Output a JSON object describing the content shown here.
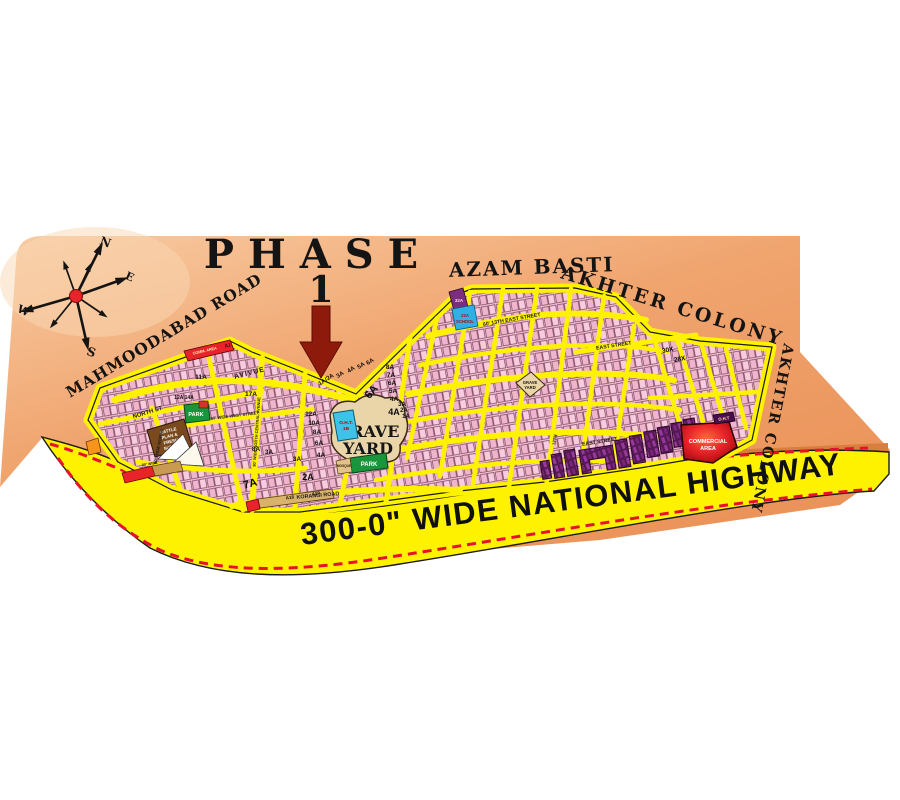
{
  "title": {
    "word": "PHASE",
    "number": "1"
  },
  "regions": {
    "azam_basti": "AZAM BASTI",
    "akhter_colony_top": "AKHTER COLONY",
    "akhter_colony_right": "AKHTER COLONY",
    "mahmoodabad_road": "MAHMOODABAD ROAD"
  },
  "highway_label": "300-0\" WIDE NATIONAL HIGHWAY",
  "compass": {
    "n": "N",
    "s": "S",
    "e": "E",
    "w": "W"
  },
  "landmarks": {
    "grave_yard_lines": [
      "GRAVE",
      "YARD"
    ],
    "grave_yard_small_lines": [
      "GRAVE",
      "YARD"
    ],
    "park_left": "PARK",
    "park_center": "PARK",
    "mosque": "MOSQUE",
    "commercial_lines": [
      "COMMERCIAL",
      "AREA"
    ],
    "comm_a1": "COMM. AREA",
    "comm_a1_code": "A1",
    "cattle_lines": [
      "CATTLE",
      "PLAN &",
      "FRESH",
      "SUPPLY"
    ],
    "oht_lines": [
      "O.H.T.",
      "1B"
    ],
    "oht_small": "O.H.T",
    "school22_lines": [
      "22A",
      "SCHOOL"
    ],
    "school32": "32A",
    "a18": "A18",
    "a19": "A19"
  },
  "streets": {
    "avenue": "AVIVUE",
    "north_st": "NORTH ST",
    "wide_north": "60' WIDE NORTH",
    "north_central": "90' WIDE NORTH CENTRAL AVENUE",
    "west_street": "60' WIDE WEST STREET",
    "korangi": "KORANGI ROAD",
    "east_13th": "60' 13TH EAST STREET",
    "east_top": "EAST STREET",
    "east_mid": "EAST STREET",
    "twelfth": "12TH",
    "eighty_wide": "80' WIDE"
  },
  "sectors": [
    {
      "t": "1A/2A"
    },
    {
      "t": "3A"
    },
    {
      "t": "4A"
    },
    {
      "t": "5A"
    },
    {
      "t": "6A"
    },
    {
      "t": "8A"
    },
    {
      "t": "7A"
    },
    {
      "t": "6A"
    },
    {
      "t": "5A"
    },
    {
      "t": "4A"
    },
    {
      "t": "6A"
    },
    {
      "t": "4A"
    },
    {
      "t": "3A"
    },
    {
      "t": "2A"
    },
    {
      "t": "1A"
    },
    {
      "t": "12A"
    },
    {
      "t": "10A"
    },
    {
      "t": "8A"
    },
    {
      "t": "6A"
    },
    {
      "t": "4A"
    },
    {
      "t": "11A"
    },
    {
      "t": "17A"
    },
    {
      "t": "12A 14A"
    },
    {
      "t": "7A"
    },
    {
      "t": "2A"
    },
    {
      "t": "3A"
    },
    {
      "t": "8A"
    },
    {
      "t": "3A"
    },
    {
      "t": "30X"
    },
    {
      "t": "28X"
    }
  ],
  "colors": {
    "peach": "#F0A46E",
    "road_yellow": "#FFF200",
    "plot_pink": "#F4C3D8",
    "dash_red": "#E8112D",
    "purple_block": "#8B2F8B",
    "park_green": "#19963B",
    "grave_tan": "#EAD5A9",
    "commercial_red": "#E8232A",
    "arrow_maroon": "#8E1A0B"
  }
}
